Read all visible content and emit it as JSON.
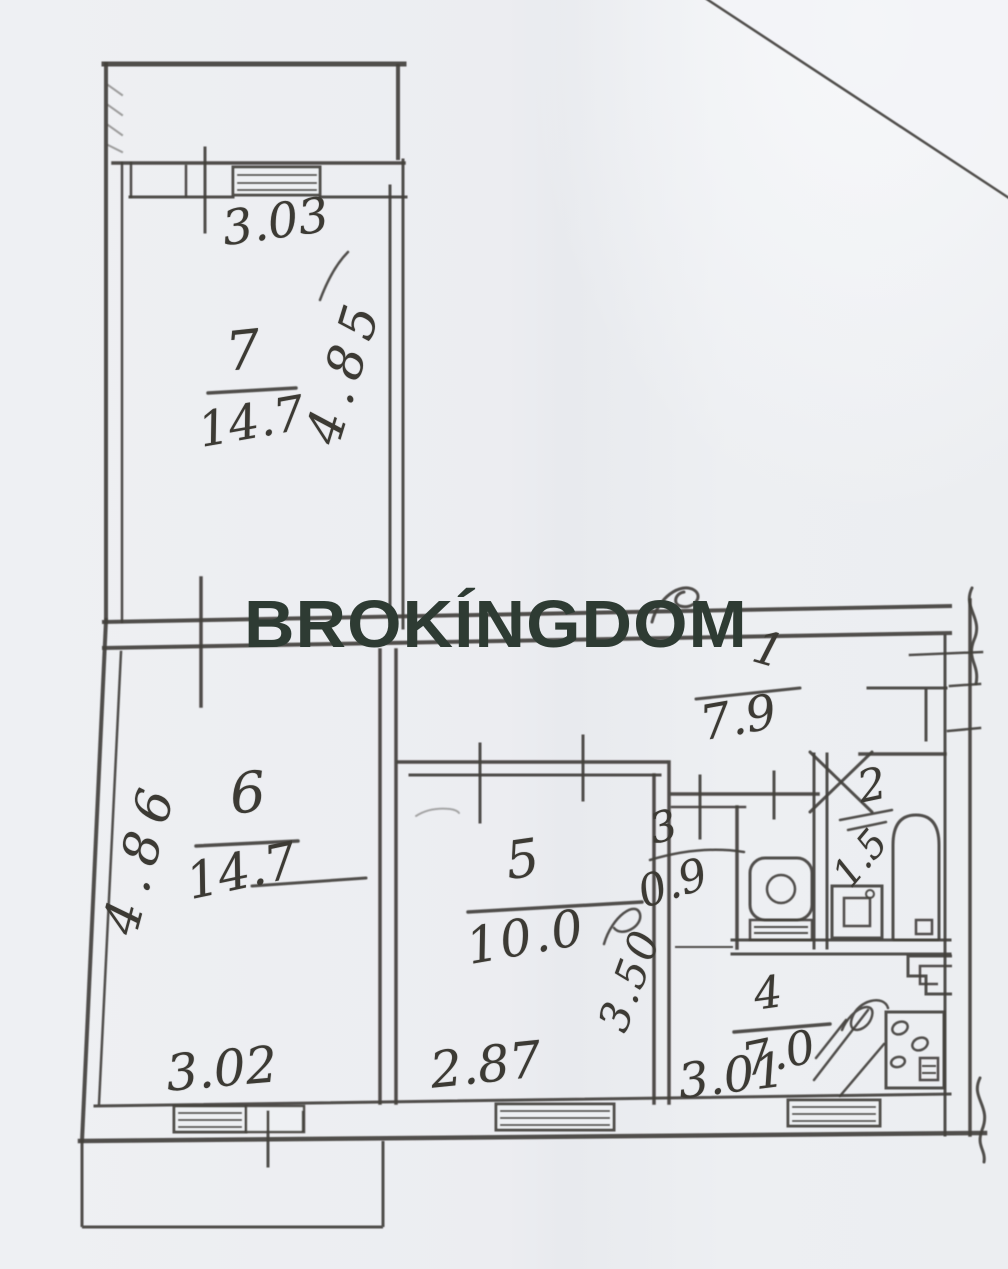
{
  "watermark": {
    "text": "BROKÍNGDOM"
  },
  "rooms": {
    "room7": {
      "number": "7",
      "area": "14.7",
      "width_top": "3.03",
      "height_side": "4.85"
    },
    "room6": {
      "number": "6",
      "area": "14.7",
      "width_bottom": "3.02",
      "height_side": "4.86"
    },
    "room5": {
      "number": "5",
      "area": "10.0",
      "width_bottom": "2.87",
      "height_side": "3.50"
    },
    "hall1": {
      "number": "1",
      "area": "7.9"
    },
    "bath2": {
      "number": "2",
      "area": "1.5"
    },
    "wc3": {
      "number": "3",
      "area": "0.9"
    },
    "kitchen4": {
      "number": "4",
      "area": "7.0",
      "width_bottom": "3.01"
    }
  }
}
